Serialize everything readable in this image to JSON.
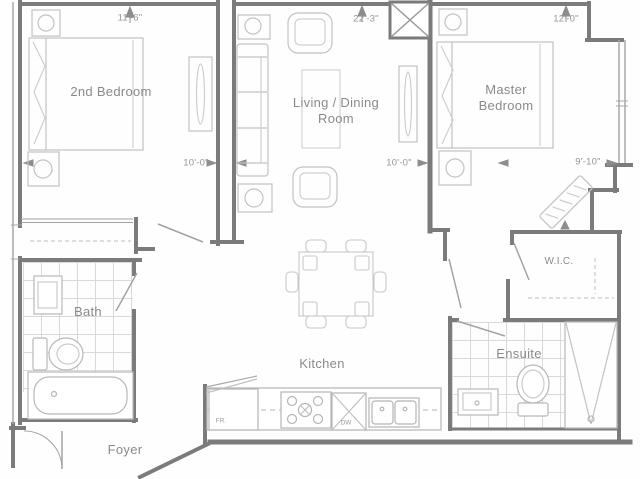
{
  "plan": {
    "title": "Two bedroom condo floor plan",
    "rooms": {
      "bedroom2": {
        "label": "2nd Bedroom",
        "width": "11'-6\"",
        "depth": "10'-0\""
      },
      "living": {
        "line1": "Living / Dining",
        "line2": "Room",
        "width": "22'-3\"",
        "depth": "10'-0\""
      },
      "master": {
        "line1": "Master",
        "line2": "Bedroom",
        "width": "12'-0\"",
        "depth": "9'-10\""
      },
      "wic": {
        "label": "W.I.C."
      },
      "bath": {
        "label": "Bath"
      },
      "ensuite": {
        "label": "Ensuite"
      },
      "kitchen": {
        "label": "Kitchen"
      },
      "foyer": {
        "label": "Foyer"
      }
    },
    "appliances": {
      "fridge": "FR.",
      "dishwasher": "DW"
    },
    "colors": {
      "background": "#fefefe",
      "wall": "#7b7b7b",
      "window_line": "#a8a8a8",
      "furniture": "#c2c2c2",
      "tile": "#d9d9d9",
      "label": "#8a8a8a",
      "dimension": "#949494"
    }
  }
}
